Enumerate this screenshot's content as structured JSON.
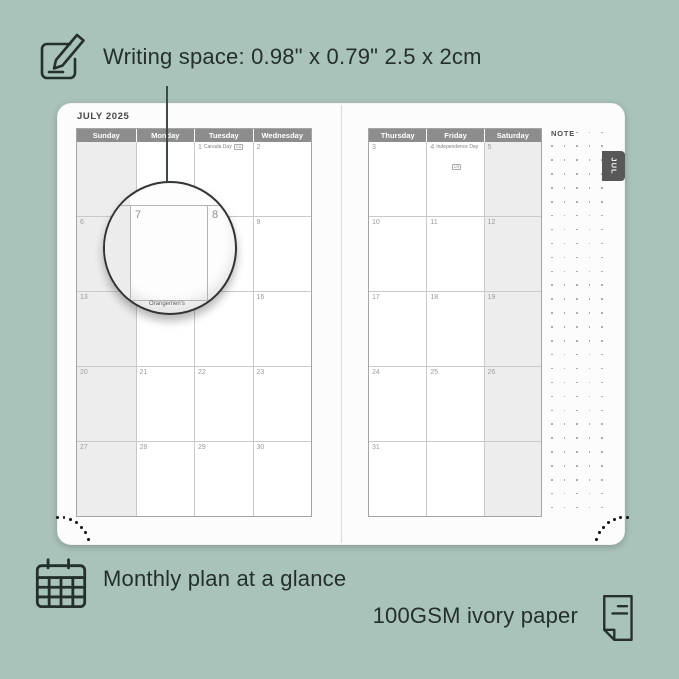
{
  "annotations": {
    "writing_space": "Writing space: 0.98\" x 0.79\" 2.5 x 2cm",
    "monthly_plan": "Monthly plan at a glance",
    "paper": "100GSM ivory paper"
  },
  "planner": {
    "month_title": "JULY 2025",
    "tab_label": "JUL",
    "note_label": "NOTE",
    "left_page": {
      "day_headers": [
        "Sunday",
        "Monday",
        "Tuesday",
        "Wednesday"
      ],
      "weeks": [
        [
          {
            "date": ""
          },
          {
            "date": ""
          },
          {
            "date": "1",
            "event": "Canada Day",
            "flag": "CA"
          },
          {
            "date": "2"
          }
        ],
        [
          {
            "date": "6"
          },
          {
            "date": "7"
          },
          {
            "date": "8"
          },
          {
            "date": "9"
          }
        ],
        [
          {
            "date": "13"
          },
          {
            "date": "14"
          },
          {
            "date": "15"
          },
          {
            "date": "16"
          }
        ],
        [
          {
            "date": "20"
          },
          {
            "date": "21"
          },
          {
            "date": "22"
          },
          {
            "date": "23"
          }
        ],
        [
          {
            "date": "27"
          },
          {
            "date": "28"
          },
          {
            "date": "29"
          },
          {
            "date": "30"
          }
        ]
      ]
    },
    "right_page": {
      "day_headers": [
        "Thursday",
        "Friday",
        "Saturday"
      ],
      "weeks": [
        [
          {
            "date": "3"
          },
          {
            "date": "4",
            "event": "Independence Day",
            "flag": "US",
            "flag_below": true
          },
          {
            "date": "5"
          }
        ],
        [
          {
            "date": "10"
          },
          {
            "date": "11"
          },
          {
            "date": "12"
          }
        ],
        [
          {
            "date": "17"
          },
          {
            "date": "18"
          },
          {
            "date": "19"
          }
        ],
        [
          {
            "date": "24"
          },
          {
            "date": "25"
          },
          {
            "date": "26"
          }
        ],
        [
          {
            "date": "31"
          },
          {
            "date": ""
          },
          {
            "date": ""
          }
        ]
      ]
    },
    "magnifier": {
      "left_date": "7",
      "right_date": "8",
      "event": "Orangemen's"
    }
  },
  "colors": {
    "background": "#a9c2ba",
    "card": "#fcfcfc",
    "header_gray": "#8d8d8d",
    "shaded_cell": "#ededed",
    "tab_gray": "#585858",
    "annotation_text": "#24302b",
    "date_text": "#9c9c9c"
  }
}
